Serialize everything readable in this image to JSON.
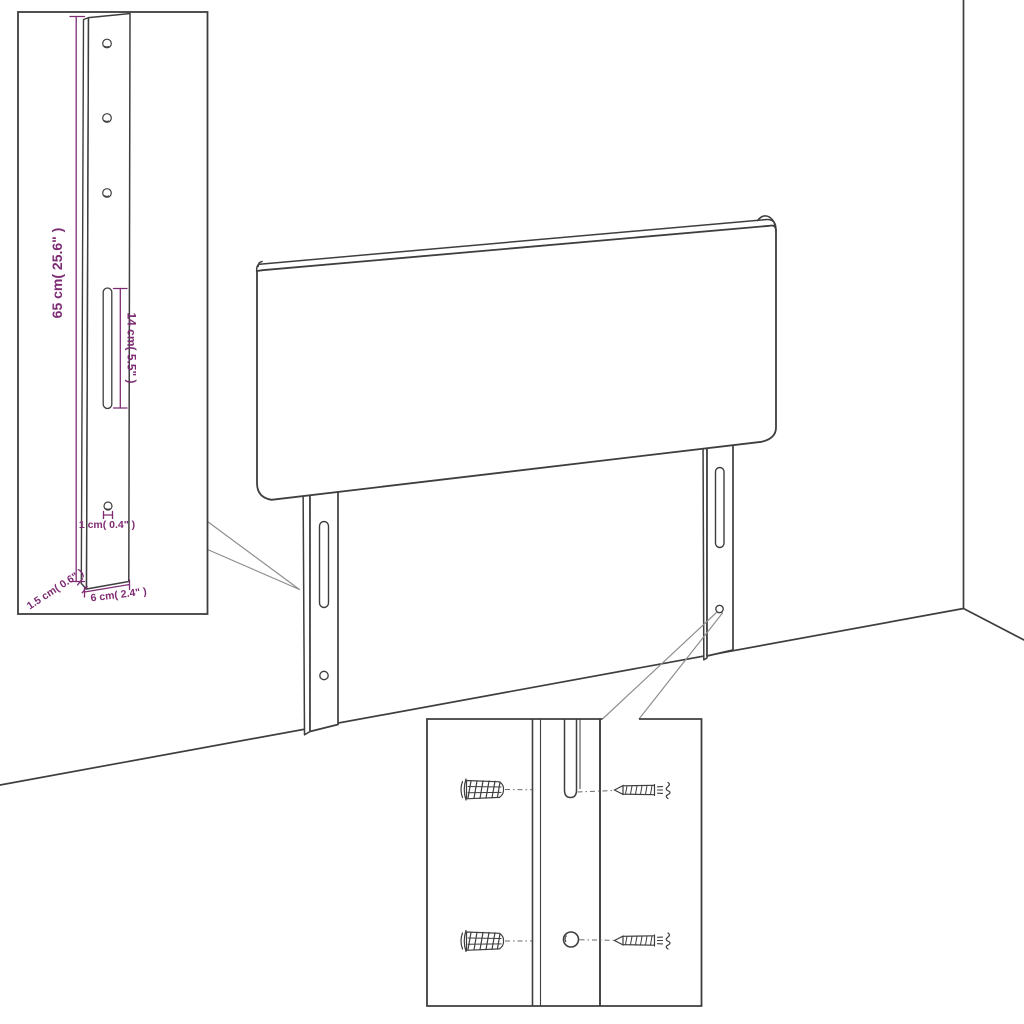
{
  "document": {
    "kind": "furniture-assembly-dimension-diagram",
    "subject": "wall-mounted headboard with two slotted mounting legs"
  },
  "colors": {
    "background": "#ffffff",
    "line": "#3e3e3e",
    "leader": "#8f8f8f",
    "dimension": "#7d2b73"
  },
  "leg_detail_inset": {
    "dimensions": {
      "total_height": {
        "label": "65 cm( 25.6\" )"
      },
      "slot_length": {
        "label": "14 cm( 5.5\" )"
      },
      "hole_diameter": {
        "label": "1 cm( 0.4\" )"
      },
      "thickness": {
        "label": "1.5 cm( 0.6\" )"
      },
      "width": {
        "label": "6 cm( 2.4\" )"
      }
    }
  },
  "mounting_detail_inset": {
    "icons": [
      "wall-plug-icon",
      "screw-icon",
      "leg-slot-icon",
      "leg-hole-icon"
    ]
  }
}
